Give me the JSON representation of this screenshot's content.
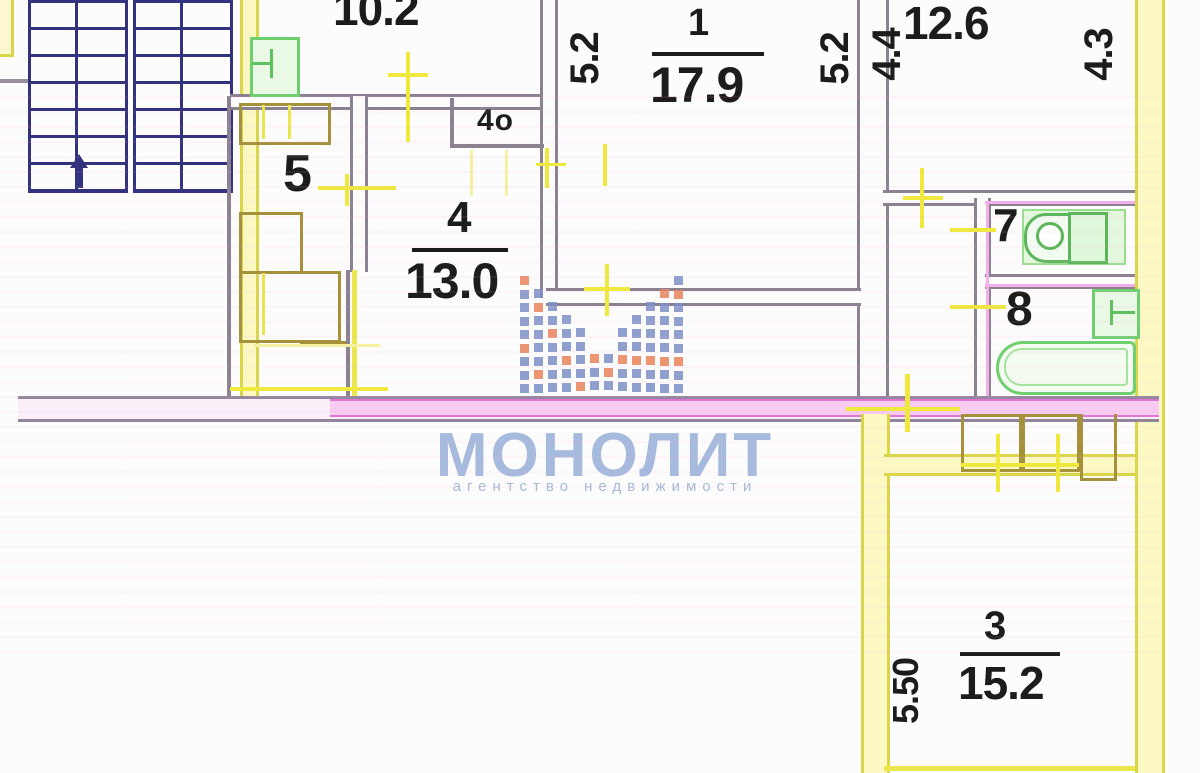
{
  "plan": {
    "type": "apartment-floor-plan",
    "rooms": [
      {
        "name": "kitchen",
        "area": "10.2"
      },
      {
        "name": "room-1",
        "number": "1",
        "area": "17.9"
      },
      {
        "name": "room-2",
        "area": "12.6"
      },
      {
        "name": "room-3",
        "number": "3",
        "area": "15.2"
      },
      {
        "name": "room-4",
        "number": "4",
        "area": "13.0"
      },
      {
        "name": "hallway",
        "number": "5"
      },
      {
        "name": "wc",
        "number": "7"
      },
      {
        "name": "bathroom",
        "number": "8"
      },
      {
        "name": "closet",
        "label": "4о"
      }
    ],
    "dimensions": {
      "room1_left": "5.2",
      "room1_right": "5.2",
      "room2_left": "4.4",
      "room2_right": "4.3",
      "room3_height": "5.50"
    }
  },
  "watermark": {
    "title": "МОНОЛИТ",
    "subtitle": "агентство недвижимости"
  },
  "colors": {
    "wall_gray": "#8b8191",
    "wall_yellow": "#e3e049",
    "wall_olive": "#a5913a",
    "wall_magenta": "#df76d5",
    "stairs_navy": "#32327e",
    "fixture_green": "#6fcf6f",
    "watermark_text": "#a6badd",
    "logo_blue": "#7b8fc7",
    "logo_orange": "#e8825a"
  }
}
